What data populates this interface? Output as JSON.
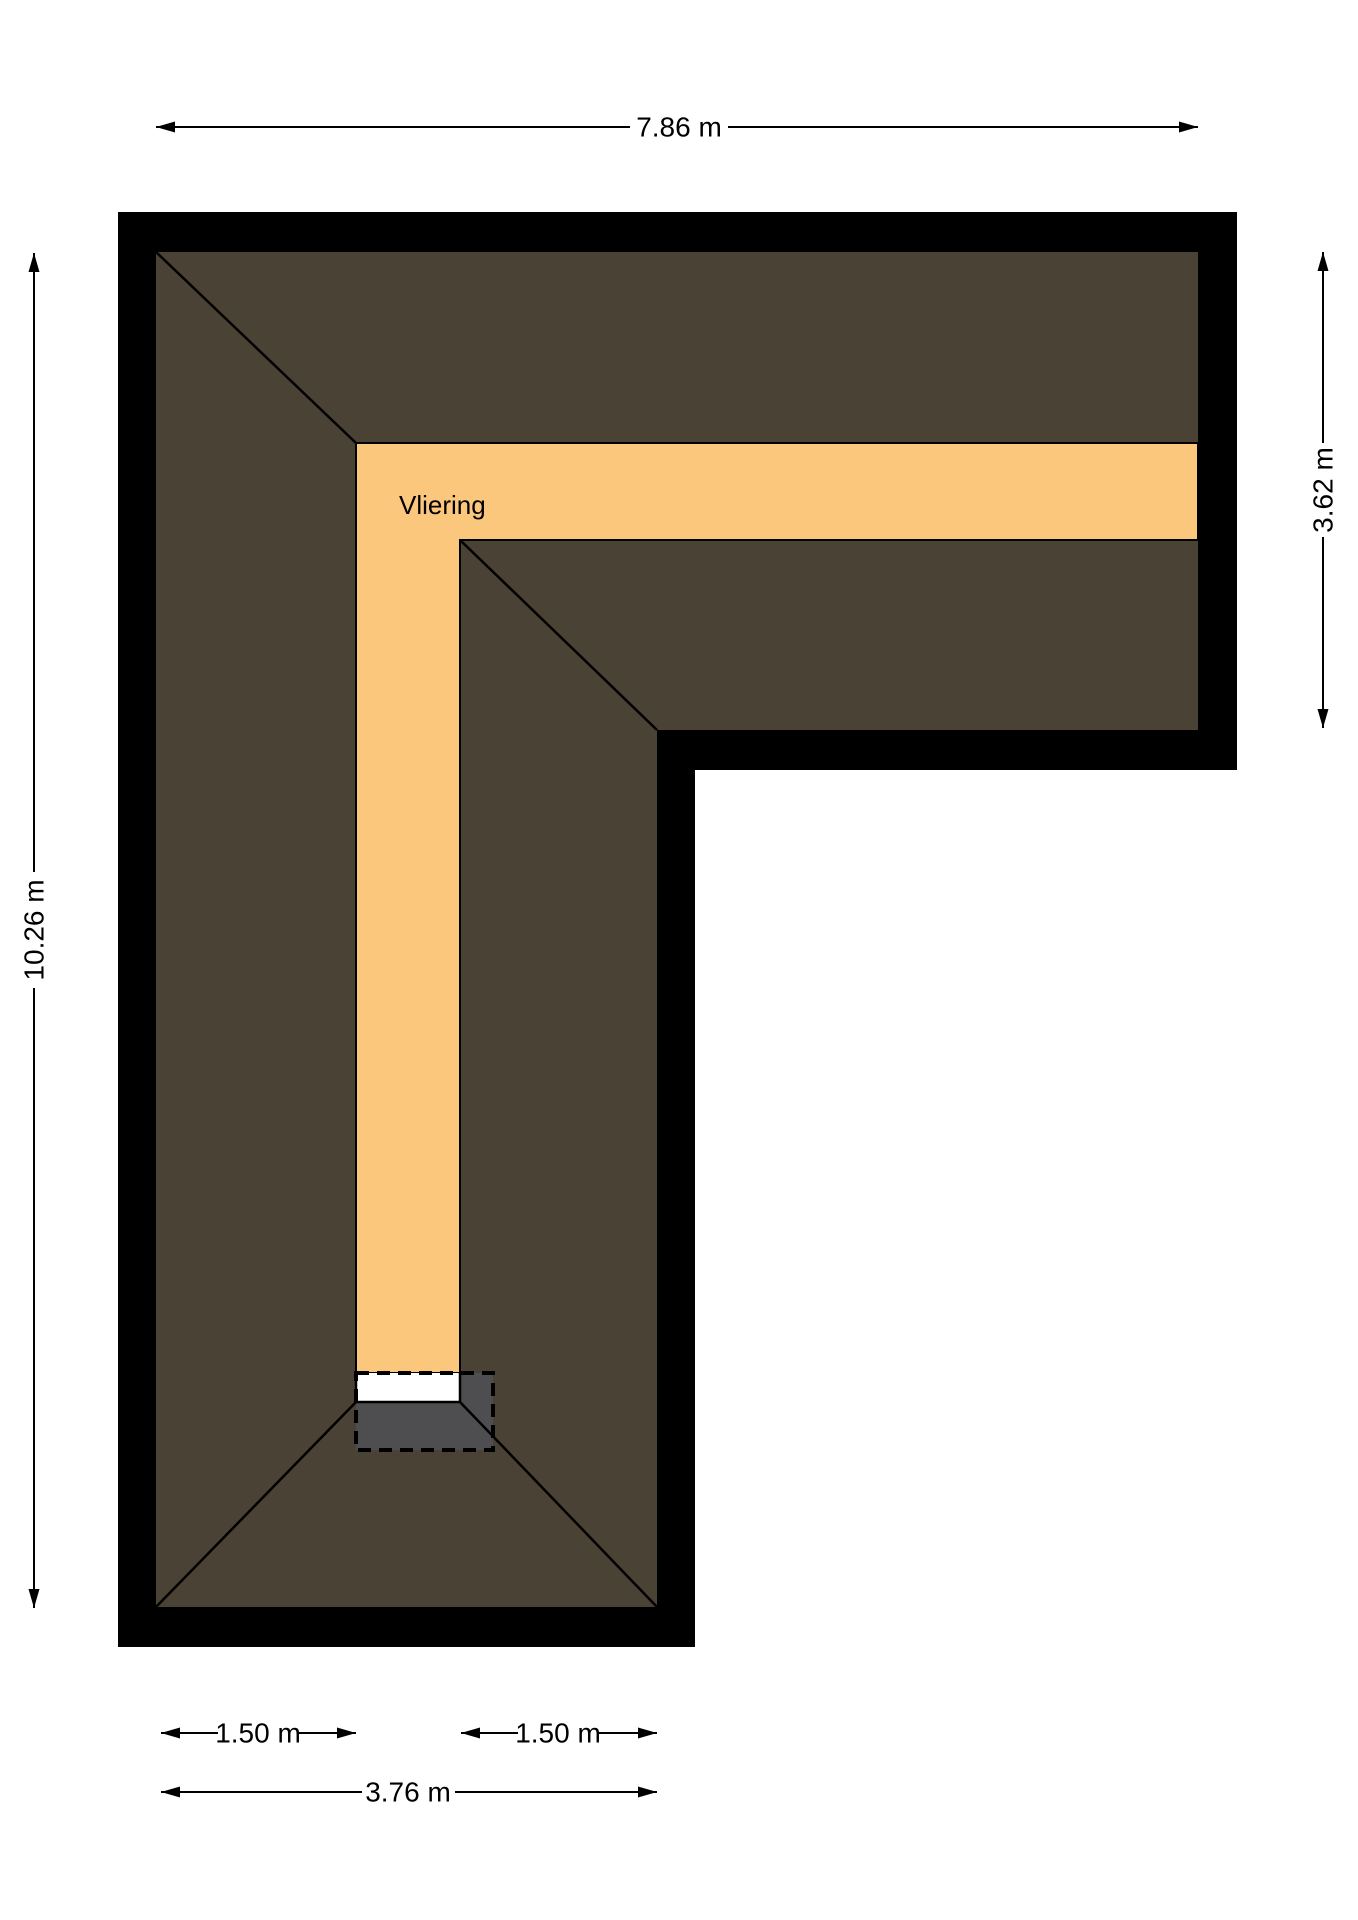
{
  "plan": {
    "room_label": "Vliering",
    "dimensions": {
      "top_width": "7.86 m",
      "left_height": "10.26 m",
      "right_height": "3.62 m",
      "bottom_left_segment": "1.50 m",
      "bottom_right_segment": "1.50 m",
      "bottom_total": "3.76 m"
    },
    "colors": {
      "wall": "#000000",
      "roof": "#4A4234",
      "vliering_floor": "#FBC77C",
      "stair_opening": "#4E4E50",
      "hatch_white": "#FFFFFF",
      "background": "#FFFFFF"
    }
  }
}
